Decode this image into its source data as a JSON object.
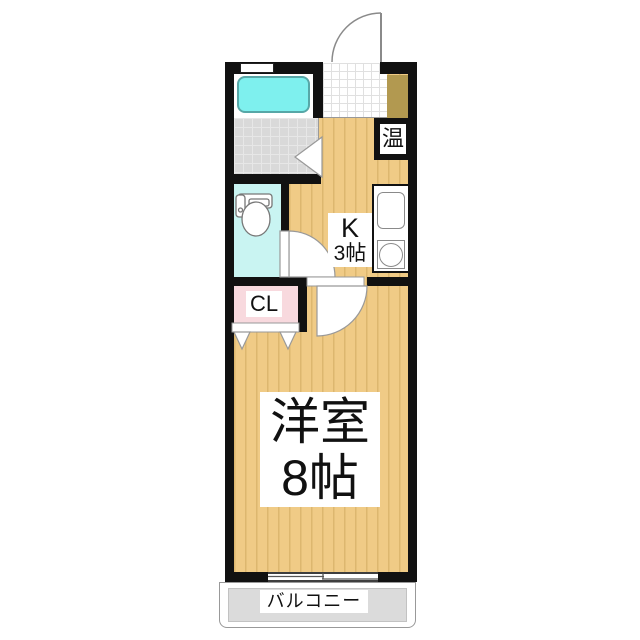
{
  "labels": {
    "kitchen_line1": "K",
    "kitchen_line2": "3帖",
    "room_line1": "洋室",
    "room_line2": "8帖",
    "closet": "CL",
    "water_heater": "温",
    "balcony": "バルコニー"
  },
  "colors": {
    "wall": "#111111",
    "floor_tan": "#f0cb86",
    "floor_stripe": "#ddb76f",
    "shoe_area": "#b29950",
    "bath_floor": "#d9d9d9",
    "bathtub": "#7ef0ee",
    "toilet_room": "#c9f4f2",
    "closet_pink": "#f8d9de",
    "balcony_gray": "#dbdbdb"
  }
}
